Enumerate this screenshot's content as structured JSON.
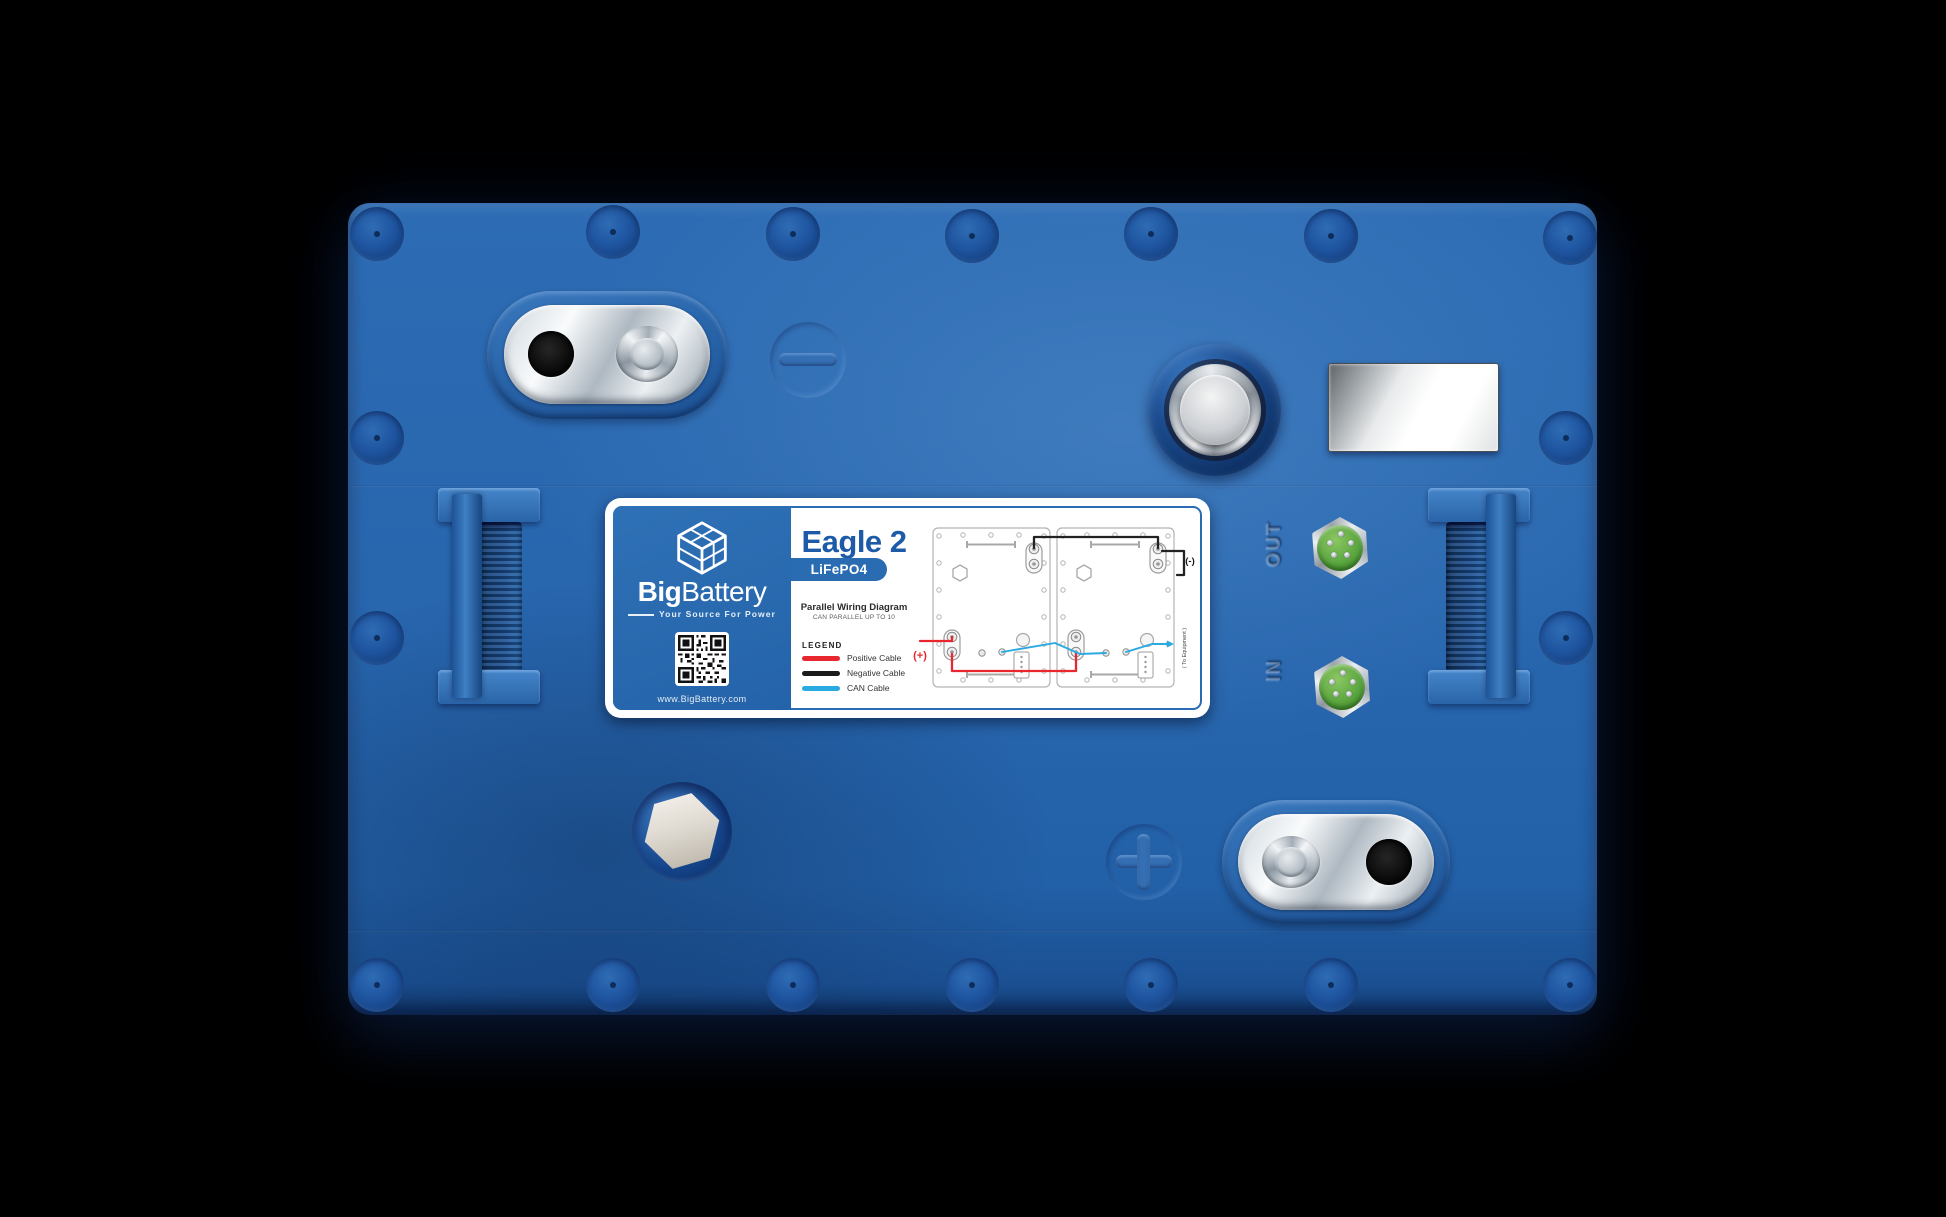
{
  "product": {
    "name": "Eagle 2",
    "chemistry": "LiFePO4"
  },
  "brand": {
    "name_bold": "Big",
    "name_regular": "Battery",
    "tagline": "Your Source For Power",
    "website": "www.BigBattery.com"
  },
  "diagram": {
    "title": "Parallel Wiring Diagram",
    "subtitle": "CAN PARALLEL UP TO 10",
    "legend_title": "LEGEND",
    "legend": [
      {
        "label": "Positive Cable",
        "color": "#e8272e"
      },
      {
        "label": "Negative Cable",
        "color": "#1b1b1b"
      },
      {
        "label": "CAN Cable",
        "color": "#29abe2"
      }
    ],
    "positive_terminal_label": "(+)",
    "negative_terminal_label": "(-)",
    "can_output_label": "( To Equipment )"
  },
  "ports": {
    "out_label": "OUT",
    "in_label": "IN"
  },
  "icons": {
    "logo": "cube-battery-logo",
    "qr": "qr-code"
  },
  "colors": {
    "case_blue": "#2765ad",
    "label_panel_blue": "#2a6cb2",
    "heading_blue": "#1d5ba8",
    "connector_green": "#56a23c",
    "positive_red": "#e8272e",
    "negative_black": "#1b1b1b",
    "can_cyan": "#29abe2"
  }
}
